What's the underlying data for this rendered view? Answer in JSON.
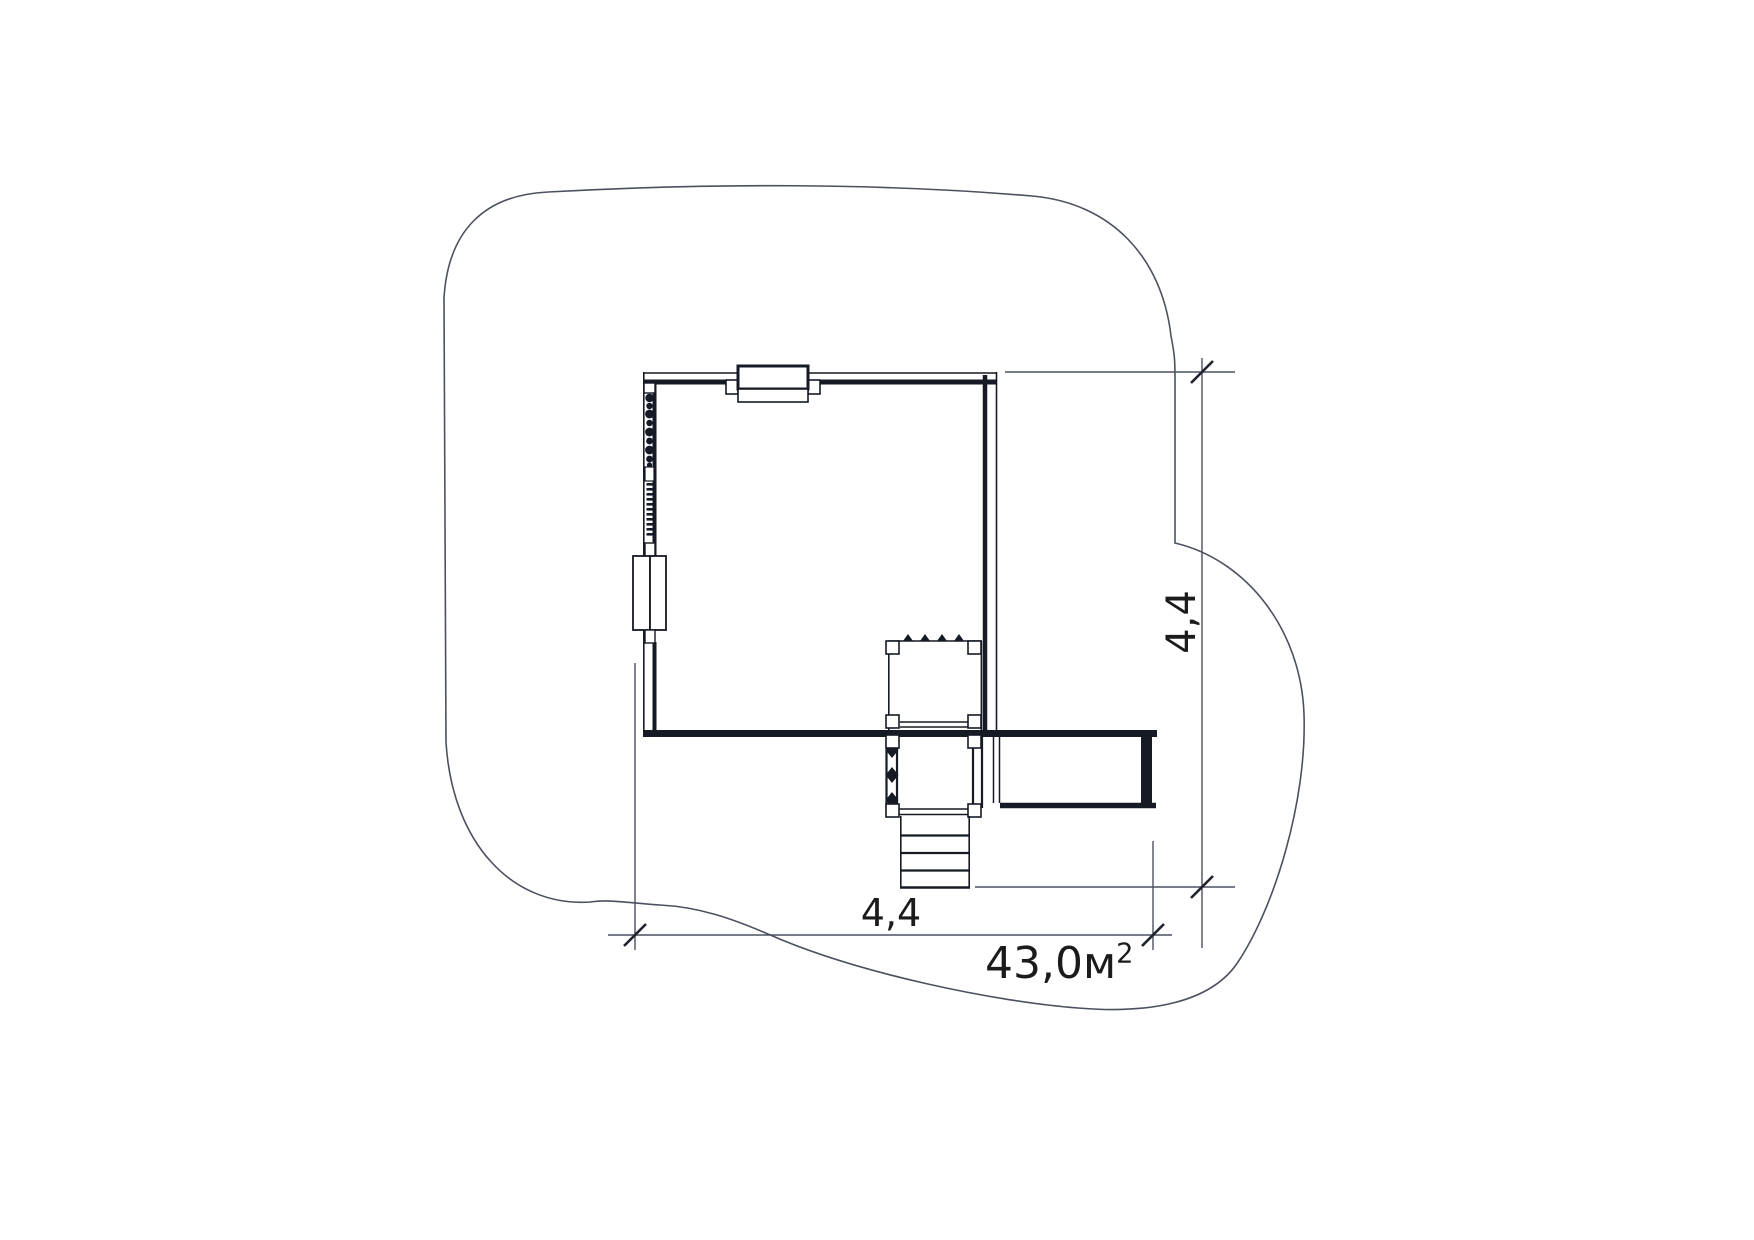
{
  "plan": {
    "vertical_dimension": {
      "label": "4,4"
    },
    "horizontal_dimension": {
      "label": "4,4"
    },
    "area_label": {
      "base": "43,0м",
      "exponent": "2"
    },
    "colors": {
      "background": "#ffffff",
      "wall_line": "#161a24",
      "thin_line": "#4c5160",
      "text": "#1b1b1b"
    }
  }
}
